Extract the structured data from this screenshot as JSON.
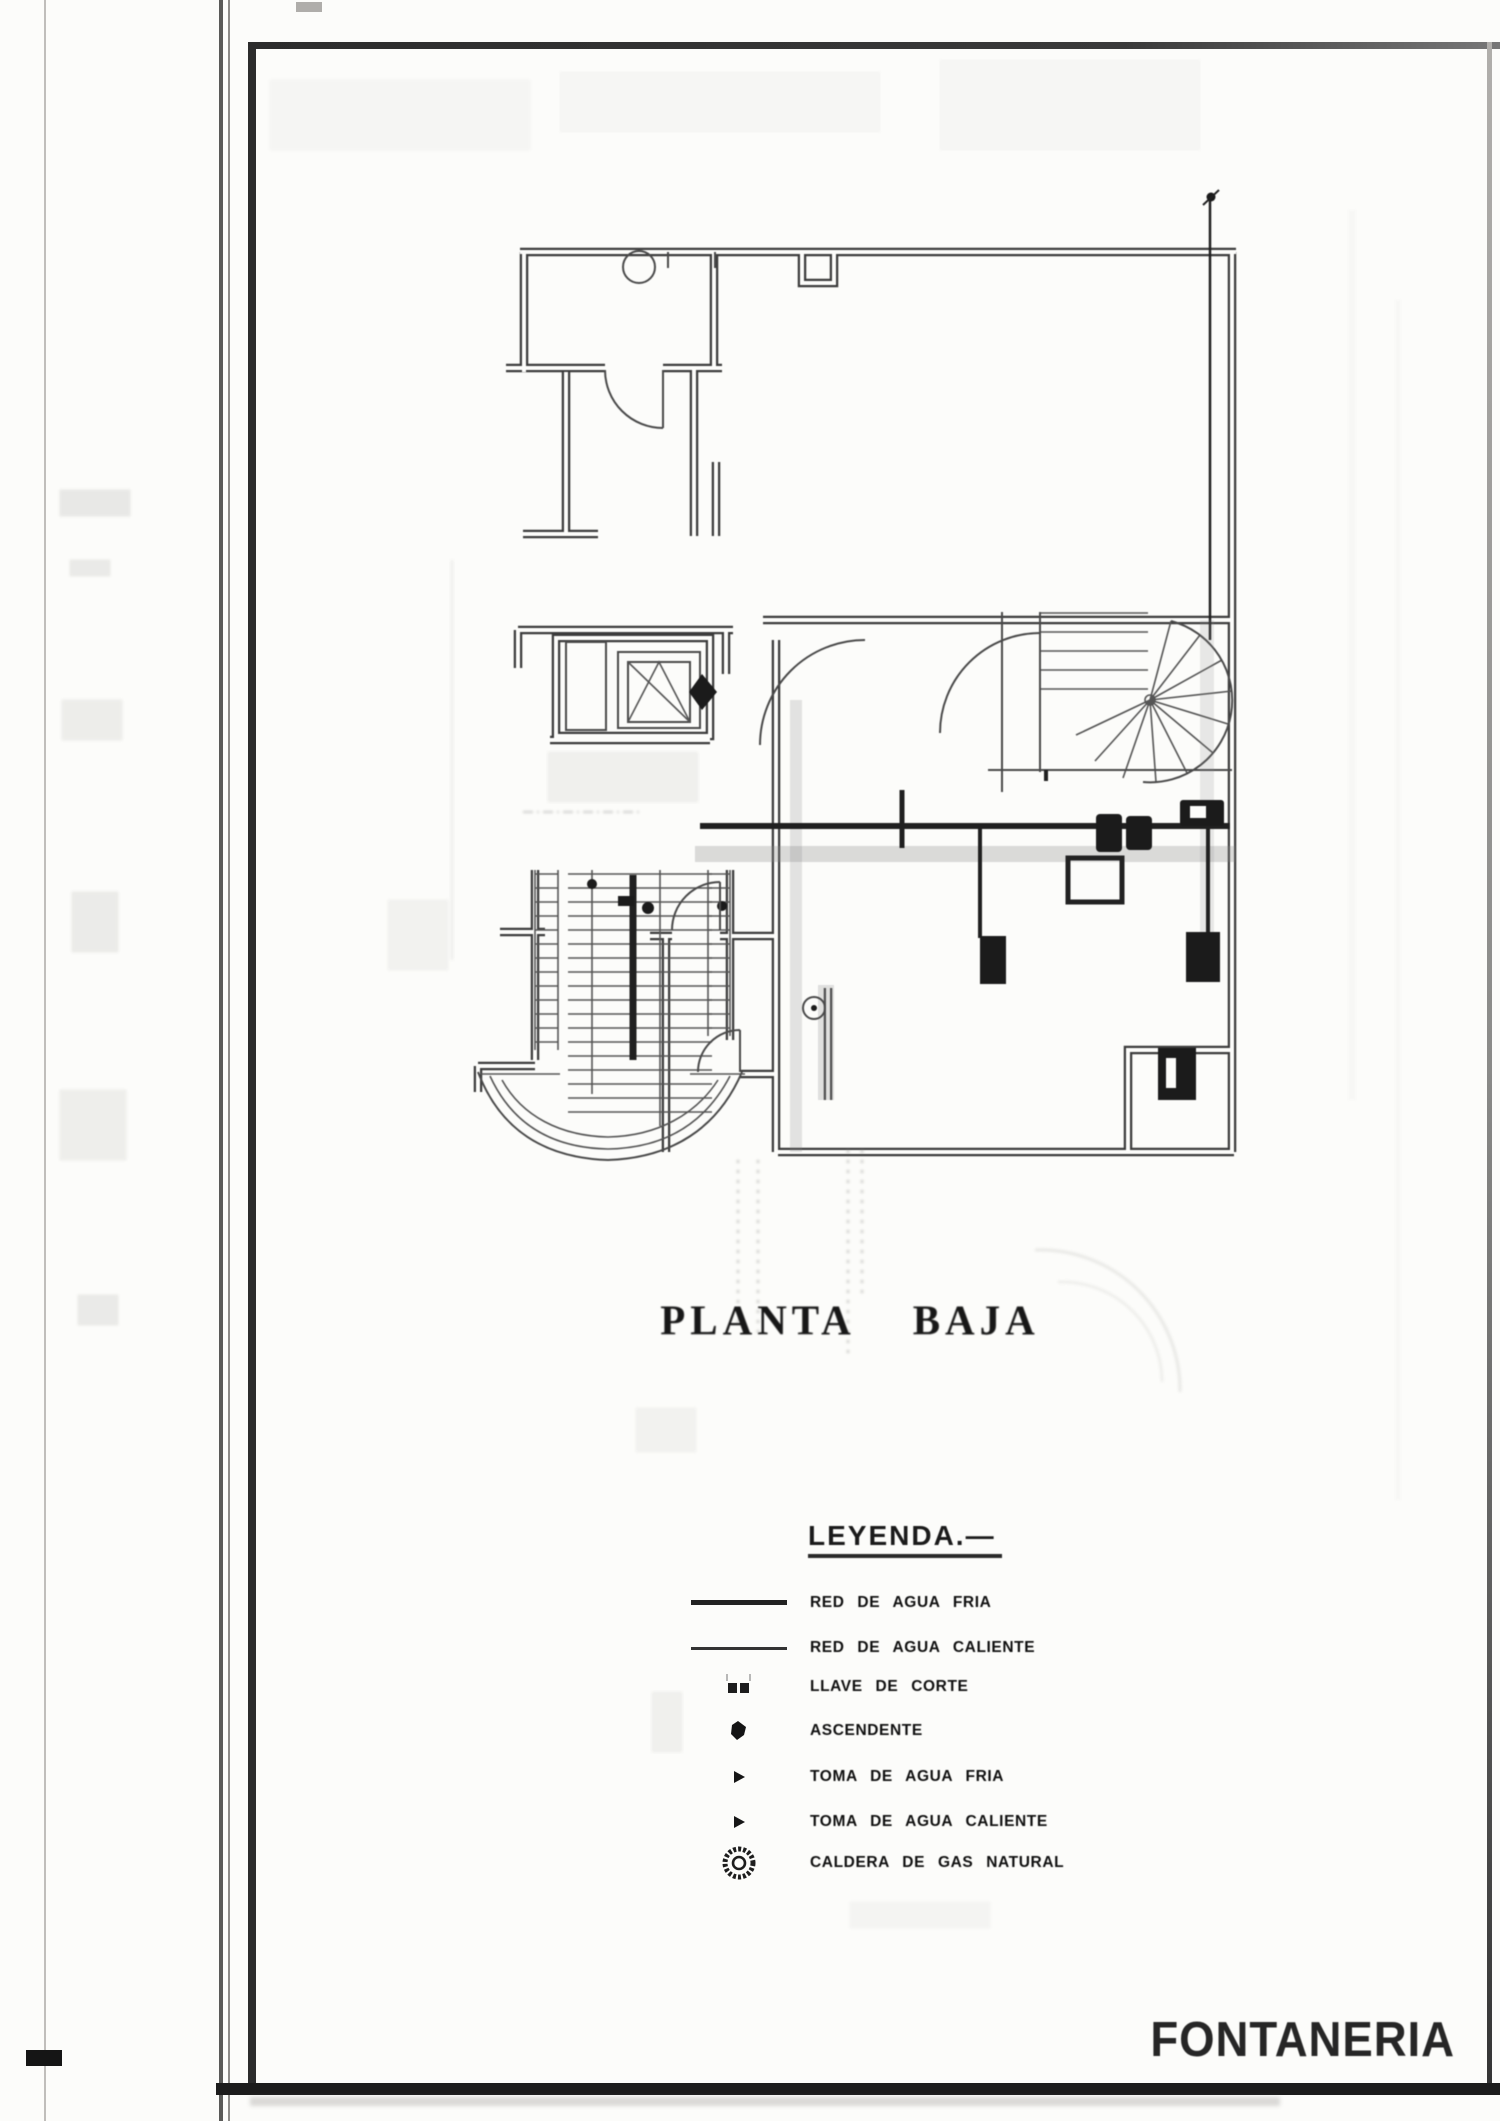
{
  "document": {
    "plan_title": "PLANTA BAJA",
    "sheet_title": "FONTANERIA"
  },
  "legend": {
    "heading": "LEYENDA.—",
    "items": [
      {
        "symbol": "cold-water-line",
        "label": "RED DE AGUA FRIA"
      },
      {
        "symbol": "hot-water-line",
        "label": "RED DE AGUA CALIENTE"
      },
      {
        "symbol": "shutoff-valve",
        "label": "LLAVE DE CORTE"
      },
      {
        "symbol": "riser",
        "label": "ASCENDENTE"
      },
      {
        "symbol": "cold-water-tap",
        "label": "TOMA DE AGUA FRIA"
      },
      {
        "symbol": "hot-water-tap",
        "label": "TOMA DE AGUA CALIENTE"
      },
      {
        "symbol": "gas-boiler",
        "label": "CALDERA DE GAS NATURAL"
      }
    ]
  },
  "colors": {
    "paper": "#fcfcfa",
    "ink": "#2f2f2f",
    "faded_ink": "#8a8a8a"
  }
}
